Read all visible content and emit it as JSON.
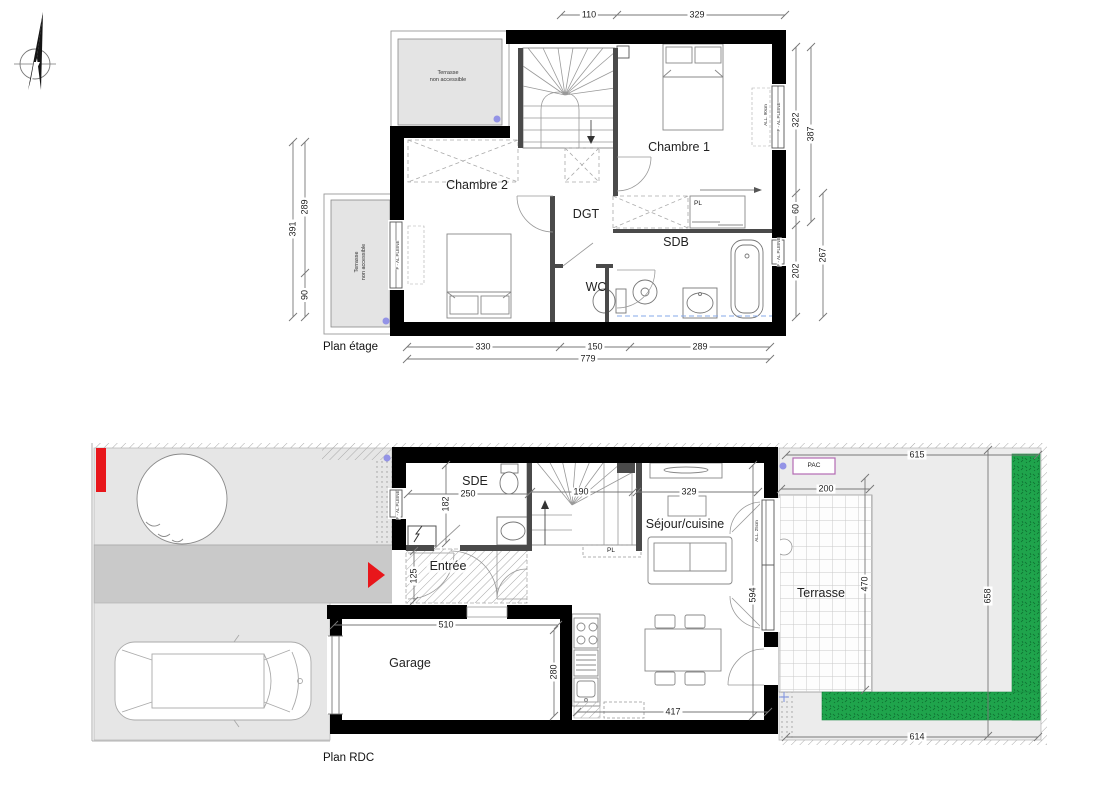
{
  "titles": {
    "plan_etage": "Plan étage",
    "plan_rdc": "Plan RDC"
  },
  "colors": {
    "hedge_green": "#1fa44c",
    "hedge_dark": "#0d6e30",
    "marker_red": "#e8161b",
    "survey_dot": "#9393e6",
    "pac_border": "#b36bb3"
  },
  "etage": {
    "rooms": {
      "chambre1": "Chambre 1",
      "chambre2": "Chambre 2",
      "dgt": "DGT",
      "sdb": "SDB",
      "wc": "WC",
      "placard": "PL",
      "terrasse_line1": "Terrasse",
      "terrasse_line2": "non accessible"
    },
    "dims": {
      "top_1": "110",
      "top_2": "329",
      "right_1": "322",
      "right_2": "60",
      "right_3": "202",
      "right_outer_1": "387",
      "right_outer_2": "267",
      "left_1": "289",
      "left_2": "90",
      "left_outer": "391",
      "bottom_1": "330",
      "bottom_2": "150",
      "bottom_3": "289",
      "bottom_total": "779"
    }
  },
  "rdc": {
    "rooms": {
      "sde": "SDE",
      "entree": "Entrée",
      "sejour": "Séjour/cuisine",
      "garage": "Garage",
      "terrasse": "Terrasse",
      "pac": "PAC",
      "placard": "PL"
    },
    "dims": {
      "sde_w": "250",
      "sde_h": "182",
      "stairs_w": "190",
      "entree_h": "125",
      "sejour_w": "329",
      "sejour_h": "594",
      "garage_w": "510",
      "garage_h": "280",
      "kitchen_w": "417",
      "terrasse_w": "200",
      "terrasse_h": "470",
      "site_top": "615",
      "site_right": "658",
      "site_bottom": "614"
    }
  },
  "annotations": {
    "window_type": "F - AL PLEINE",
    "window_allege_90": "ALL. 90cm",
    "window_allege_25": "ALL. 25cm"
  }
}
